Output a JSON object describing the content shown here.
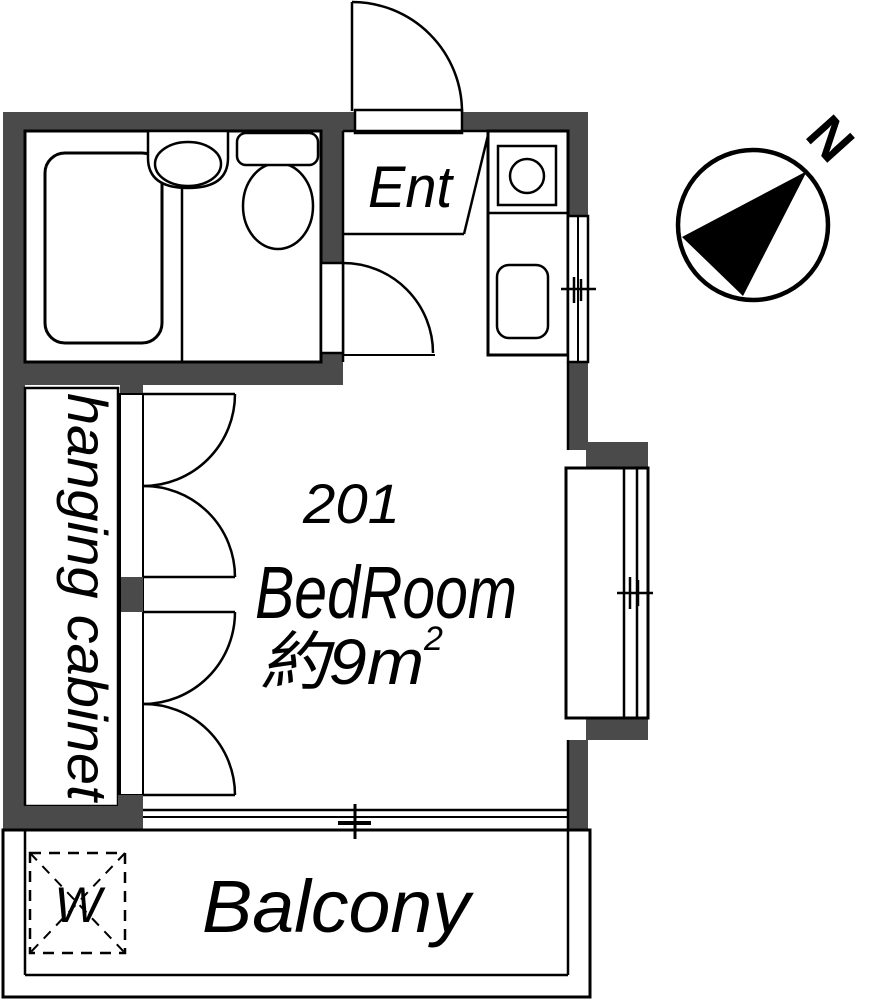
{
  "document": {
    "type": "apartment-floor-plan"
  },
  "labels": {
    "entrance": "Ent",
    "unit_number": "201",
    "bedroom": "BedRoom",
    "area": "約9m",
    "area_superscript": "2",
    "hanging_cabinet": "hanging cabinet",
    "balcony": "Balcony",
    "washing_machine": "W"
  },
  "compass": {
    "north": "N"
  },
  "colors": {
    "wall": "#4a4a4a",
    "line": "#000000",
    "floor": "#ffffff"
  }
}
